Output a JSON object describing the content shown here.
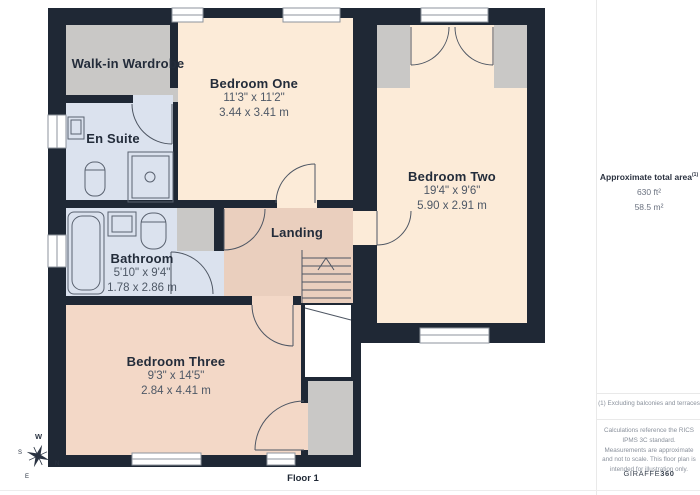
{
  "plan": {
    "rooms": [
      {
        "name": "Walk-in Wardrobe"
      },
      {
        "name": "En Suite"
      },
      {
        "name": "Bedroom One",
        "dim_imperial": "11'3\" x 11'2\"",
        "dim_metric": "3.44 x 3.41 m"
      },
      {
        "name": "Bedroom Two",
        "dim_imperial": "19'4\" x 9'6\"",
        "dim_metric": "5.90 x 2.91 m"
      },
      {
        "name": "Bathroom",
        "dim_imperial": "5'10\" x 9'4\"",
        "dim_metric": "1.78 x 2.86 m"
      },
      {
        "name": "Landing"
      },
      {
        "name": "Bedroom Three",
        "dim_imperial": "9'3\" x 14'5\"",
        "dim_metric": "2.84 x 4.41 m"
      }
    ],
    "floor_label": "Floor 1",
    "compass": {
      "n": "N",
      "s": "S",
      "e": "E",
      "w": "W"
    }
  },
  "info_panel": {
    "area_heading": "Approximate total area",
    "area_heading_note": "(1)",
    "area_imperial": "630 ft²",
    "area_metric": "58.5 m²",
    "footnote": "(1) Excluding balconies and terraces",
    "disclaimer": "Calculations reference the RICS IPMS 3C standard. Measurements are approximate and not to scale. This floor plan is intended for illustration only.",
    "brand": {
      "name": "GIRAFFE",
      "suffix": "360"
    }
  },
  "colors": {
    "wall": "#1f2835",
    "bedroom_fill": "#fcebd8",
    "landing_fill": "#eacfbe",
    "bedroom_three_fill": "#f3d8c7",
    "bath_fill": "#dbe2ee",
    "closet_fill": "#c9c8c6",
    "line": "#4e5663",
    "label": "#232c3a",
    "dim_text": "#4e5866",
    "muted_text": "#8a919c"
  }
}
